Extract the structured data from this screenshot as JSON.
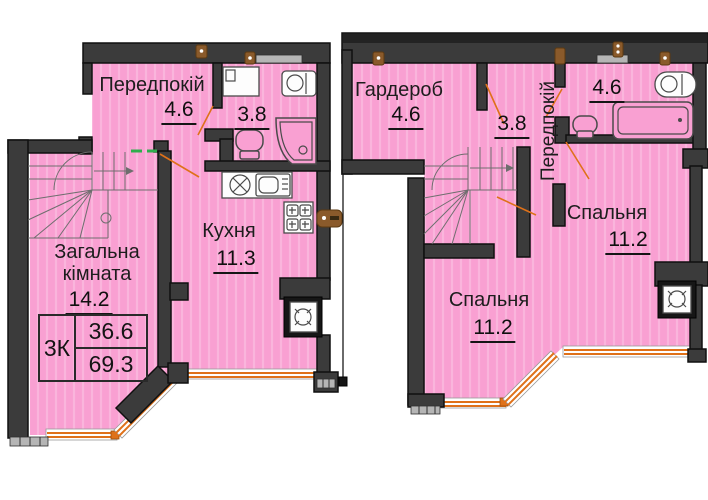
{
  "floor1": {
    "hallway": {
      "label": "Передпокій",
      "area": "4.6"
    },
    "bathroom": {
      "area": "3.8"
    },
    "kitchen": {
      "label": "Кухня",
      "area": "11.3"
    },
    "living_room": {
      "label": "Загальна кімната",
      "area": "14.2"
    },
    "summary_table": {
      "apartment_type": "3К",
      "living_area": "36.6",
      "total_area": "69.3"
    }
  },
  "floor2": {
    "wardrobe": {
      "label": "Гардероб",
      "area": "4.6"
    },
    "hall_area": {
      "area": "3.8"
    },
    "corridor": {
      "label": "Передпокій"
    },
    "bathroom": {
      "area": "4.6"
    },
    "bedroom_right": {
      "label": "Спальня",
      "area": "11.2"
    },
    "bedroom_left": {
      "label": "Спальня",
      "area": "11.2"
    }
  },
  "colors": {
    "room_fill": "#f9a0d2",
    "wall": "#3b3b3b",
    "window_frame": "#df7119",
    "vent_marker": "#8a5a2b",
    "door_mark": "#2fae4d"
  }
}
